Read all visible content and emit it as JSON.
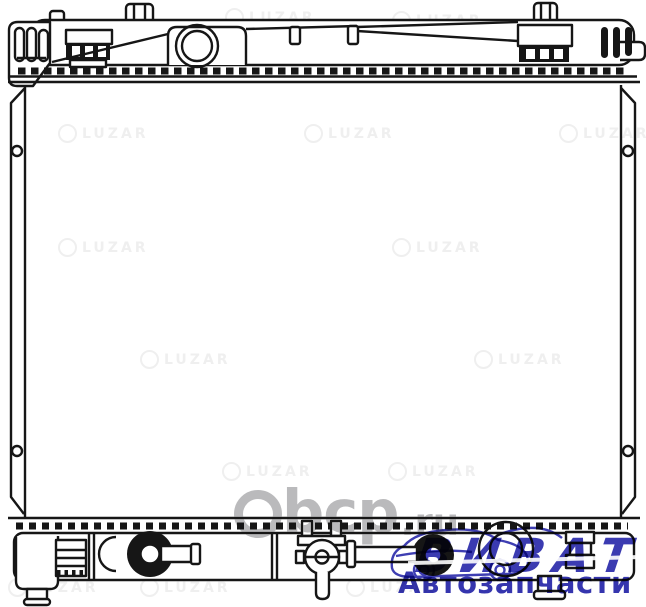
{
  "meta": {
    "description": "Technical line drawing (front view) of an automotive engine-cooling radiator, catalog product image"
  },
  "drawing": {
    "part": "radiator",
    "line_color": "#161616",
    "background_color": "#ffffff"
  },
  "watermarks": {
    "center_site": {
      "main": "bcp",
      "tld": ".ru",
      "color": "#b4b4b6"
    },
    "brand_tile": {
      "text": "LUZAR",
      "color": "#efefef"
    },
    "seller_logo": {
      "title": "ВИВАТ",
      "subtitle": "Автозапчасти",
      "color": "#2a2aaa"
    }
  }
}
